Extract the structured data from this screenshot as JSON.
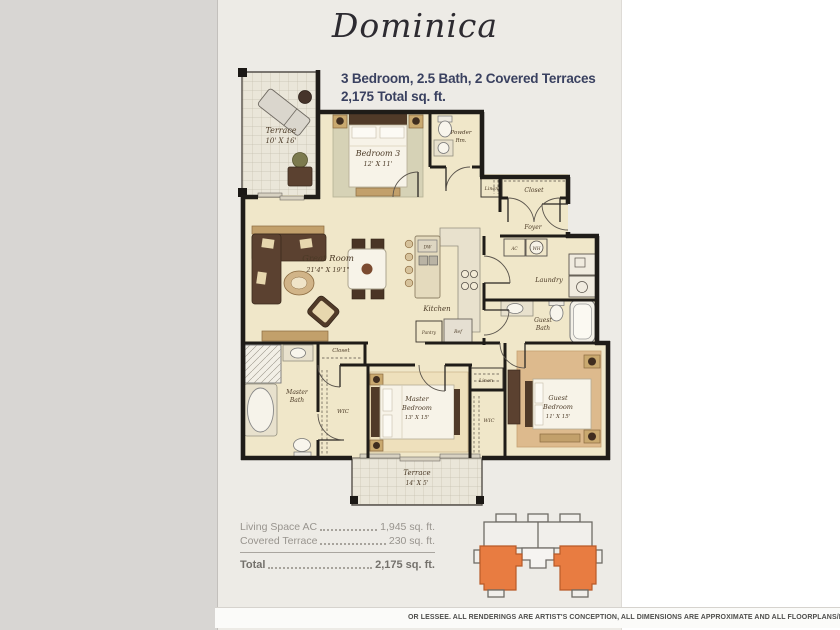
{
  "header": {
    "title": "Dominica",
    "specs_line1": "3 Bedroom, 2.5 Bath, 2 Covered Terraces",
    "specs_line2": "2,175 Total sq. ft."
  },
  "floorplan": {
    "terrace_upper": {
      "name": "Terrace",
      "dims": "10' X 16'"
    },
    "bedroom3": {
      "name": "Bedroom 3",
      "dims": "12' X 11'"
    },
    "powder": {
      "line1": "Powder",
      "line2": "Rm."
    },
    "linen_upper": "Linen",
    "entry_closet": "Closet",
    "foyer": "Foyer",
    "ac": "AC",
    "wh": "WH",
    "great_room": {
      "name": "Great Room",
      "dims": "21'4\" X 19'1\""
    },
    "kitchen": "Kitchen",
    "dw": "DW",
    "pantry": "Pantry",
    "ref": "Ref",
    "laundry": "Laundry",
    "guest_bath": {
      "line1": "Guest",
      "line2": "Bath"
    },
    "hall_closet": "Closet",
    "master_bath": {
      "line1": "Master",
      "line2": "Bath"
    },
    "wic_master": "WIC",
    "master_bedroom": {
      "line1": "Master",
      "line2": "Bedroom",
      "dims": "13' X 15'"
    },
    "linen_lower": "Linen",
    "wic_guest": "WIC",
    "guest_bedroom": {
      "line1": "Guest",
      "line2": "Bedroom",
      "dims": "11' X 15'"
    },
    "terrace_lower": {
      "name": "Terrace",
      "dims": "14' X 5'"
    }
  },
  "summary": {
    "rows": [
      {
        "label": "Living Space AC",
        "value": "1,945 sq. ft."
      },
      {
        "label": "Covered Terrace",
        "value": "230 sq. ft."
      }
    ],
    "total": {
      "label": "Total",
      "value": "2,175 sq. ft."
    }
  },
  "disclaimer": "OR LESSEE. ALL RENDERINGS ARE ARTIST'S CONCEPTION, ALL DIMENSIONS ARE APPROXIMATE AND ALL FLOORPLANS/D",
  "colors": {
    "unit_highlight_orange": "#e87c41",
    "header_text_navy": "#3a4160",
    "page_background": "#edebe6",
    "plan_interior": "#f0e7c9"
  }
}
